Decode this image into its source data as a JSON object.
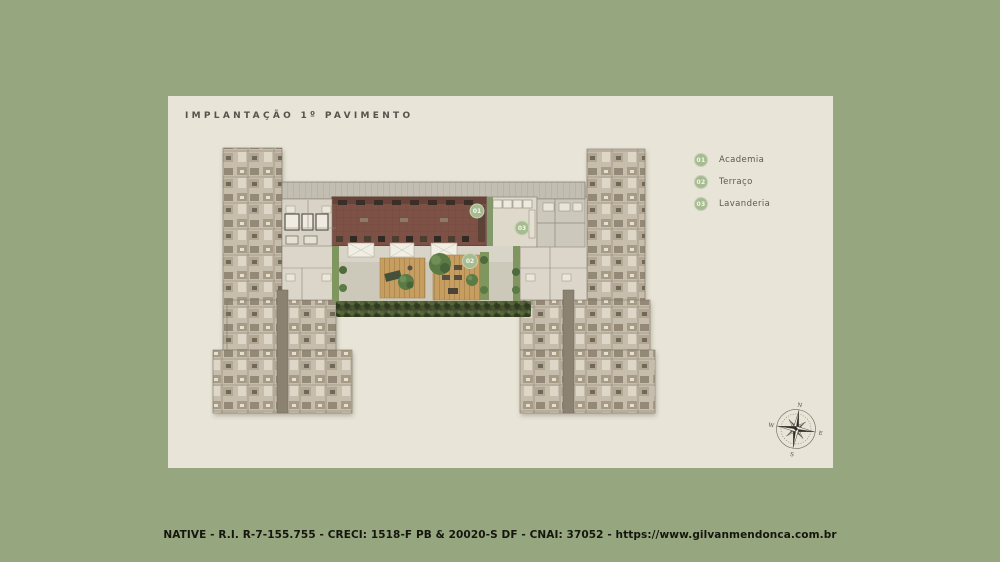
{
  "title": "IMPLANTAÇÃO 1º PAVIMENTO",
  "legend": {
    "items": [
      {
        "number": "01",
        "label": "Academia"
      },
      {
        "number": "02",
        "label": "Terraço"
      },
      {
        "number": "03",
        "label": "Lavanderia"
      }
    ]
  },
  "compass": {
    "north": "N",
    "east": "E",
    "south": "S",
    "west": "W"
  },
  "footer": {
    "text": "NATIVE - R.I. R-7-155.755 - CRECI: 1518-F PB & 20020-S DF - CNAI: 37052 - https://www.gilvanmendonca.com.br"
  },
  "colors": {
    "background": "#96a67f",
    "card": "#e8e4d7",
    "badge_green": "#a6bb90",
    "gym_floor": "#7d5145",
    "hedge_green": "#3f4a2c",
    "deck_wood": "#c69e62",
    "title_text": "#55534b",
    "footer_text": "#16160f"
  }
}
